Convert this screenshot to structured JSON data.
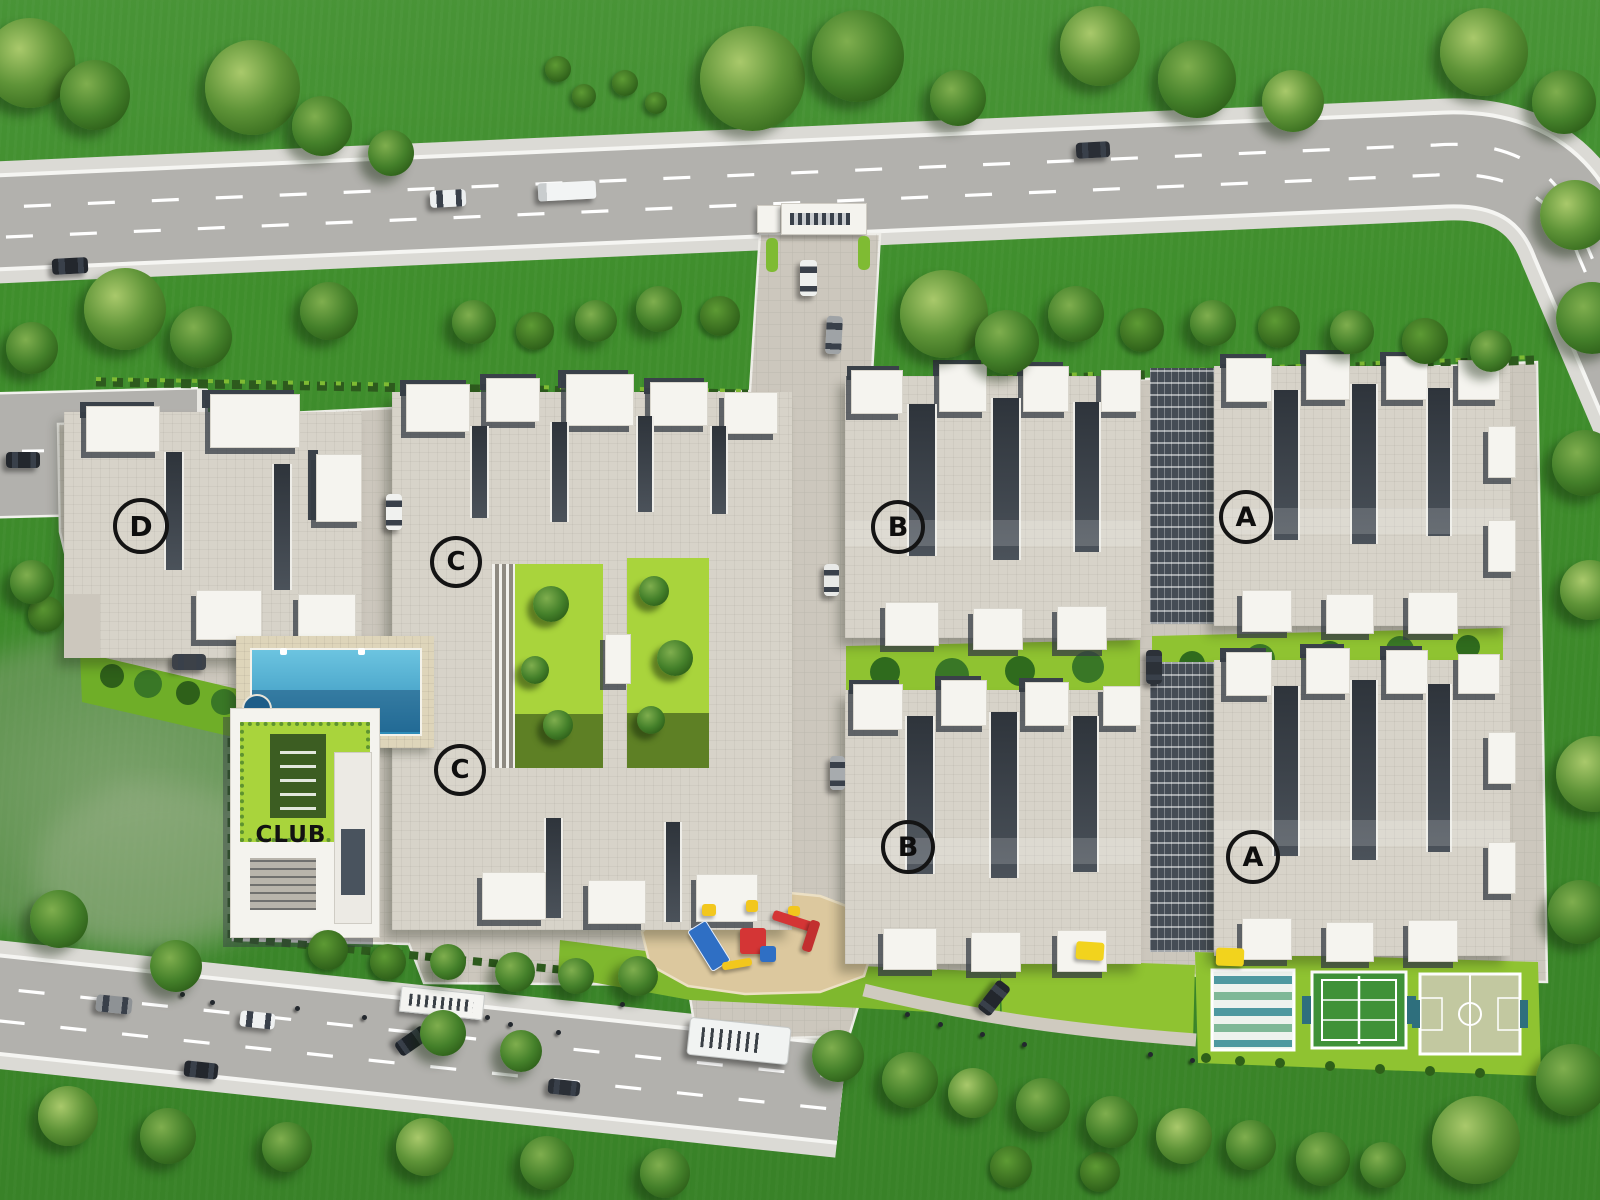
{
  "page": {
    "title": "Residential Township Master Layout Plan - Aerial View"
  },
  "site": {
    "building_labels": {
      "d": "D",
      "c_upper": "C",
      "c_lower": "C",
      "b_upper": "B",
      "b_lower": "B",
      "a_upper": "A",
      "a_lower": "A"
    },
    "club_label": "CLUB",
    "amenities": [
      "entrance-gate",
      "swimming-pool",
      "kids-jacuzzi",
      "clubhouse",
      "children-play-area",
      "central-landscaped-courtyards",
      "lawns",
      "striped-deck-court",
      "tennis-court",
      "basketball-court",
      "internal-driveways",
      "perimeter-roads"
    ],
    "colors": {
      "grass": "#3f8e2c",
      "tree": "#4f8a2b",
      "road": "#b2b1ad",
      "sidewalk": "#dbdad5",
      "paving": "#ccc7bd",
      "roof": "#d7d3c9",
      "parapet": "#f5f4ef",
      "shadow": "#3a4149",
      "lime_lawn": "#8fc331",
      "pool_water": "#3ea3cd",
      "pool_deck": "#ded5ba",
      "sand": "#dcc89e",
      "play_red": "#d43535",
      "play_blue": "#2f6fc4",
      "play_yellow": "#f2c71d",
      "court_green": "#3f9138",
      "court_khaki": "#c2c8a0",
      "court_teal": "#2e7f86"
    }
  }
}
